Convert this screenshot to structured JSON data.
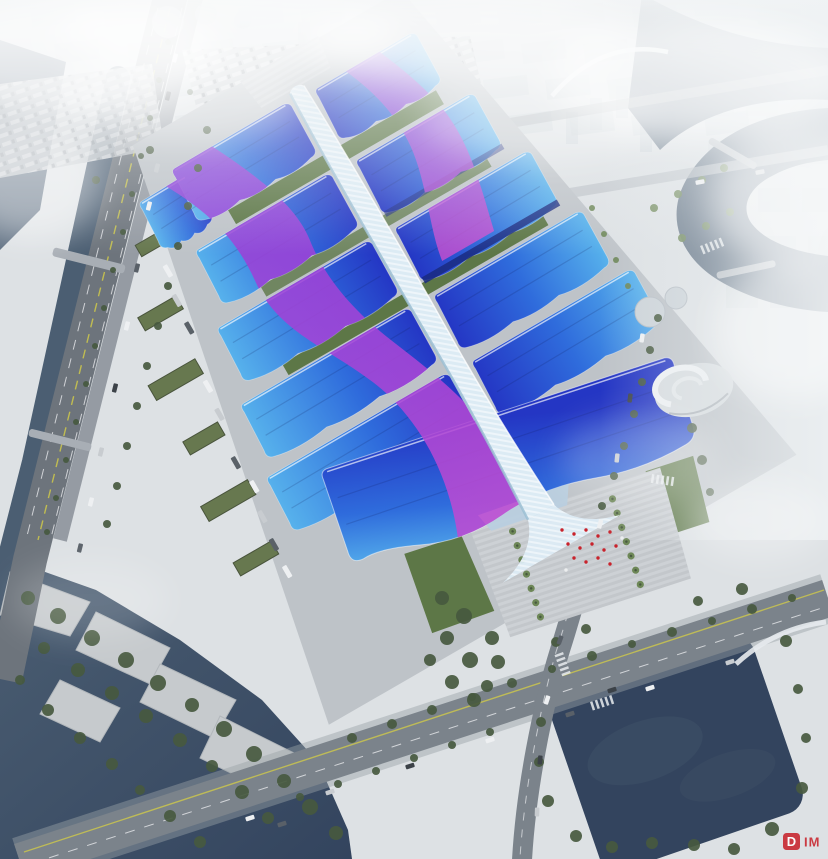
{
  "meta": {
    "title": "Aerial rendering of a mega exhibition and convention center",
    "media_type": "architectural-rendering"
  },
  "scene": {
    "description": "Bird's-eye perspective rendering: rows of wavy blue exhibition-hall roofs with sweeping purple ribbon bands flank a white lattice central concourse spine that cascades into a grand south entrance. The complex is ringed by gray service aprons, truck parking lots, green-roof service sheds, palm-lined entry plazas with red flags, an elevated riverside highway, a tree-lined boulevard, dark ponds and canals, waterfront parks, and a city skyline dissolving into white mist.",
    "landmarks": [
      "central concourse spine",
      "exhibition hall roofs",
      "grand south hall",
      "south entrance plaza with red flags",
      "green garden strips between halls",
      "green-roof service sheds",
      "truck parking lot",
      "elevated riverside highway",
      "south boulevard",
      "spiral landmark pavilion",
      "bottom-left waterfront park",
      "bottom-right pond",
      "misty city skyline"
    ],
    "watermark": {
      "badge_letter": "D",
      "text": "IM"
    }
  },
  "colors": {
    "haze": "#f3f5f6",
    "ground": "#bec3c8",
    "plaza": "#c7cbd0",
    "roadDark": "#6d747c",
    "roadMid": "#7b838b",
    "roadLight": "#9aa1a7",
    "laneYellow": "#cfc94a",
    "water": "#4b5e72",
    "pond": "#33445e",
    "treeDark": "#47593f",
    "treeLight": "#6d8757",
    "lawn": "#5d7747",
    "roofLight": "#57b2ec",
    "roofMid": "#2f6cdc",
    "roofDeep": "#2436c4",
    "roofRim": "#1a2a80",
    "ribbonA": "#8f3ed8",
    "ribbonB": "#cb4ecf",
    "spine": "#dcebf4",
    "spineShade": "#9cc0d4",
    "blocks": "#c2ccd2",
    "accentRed": "#c8232c"
  }
}
